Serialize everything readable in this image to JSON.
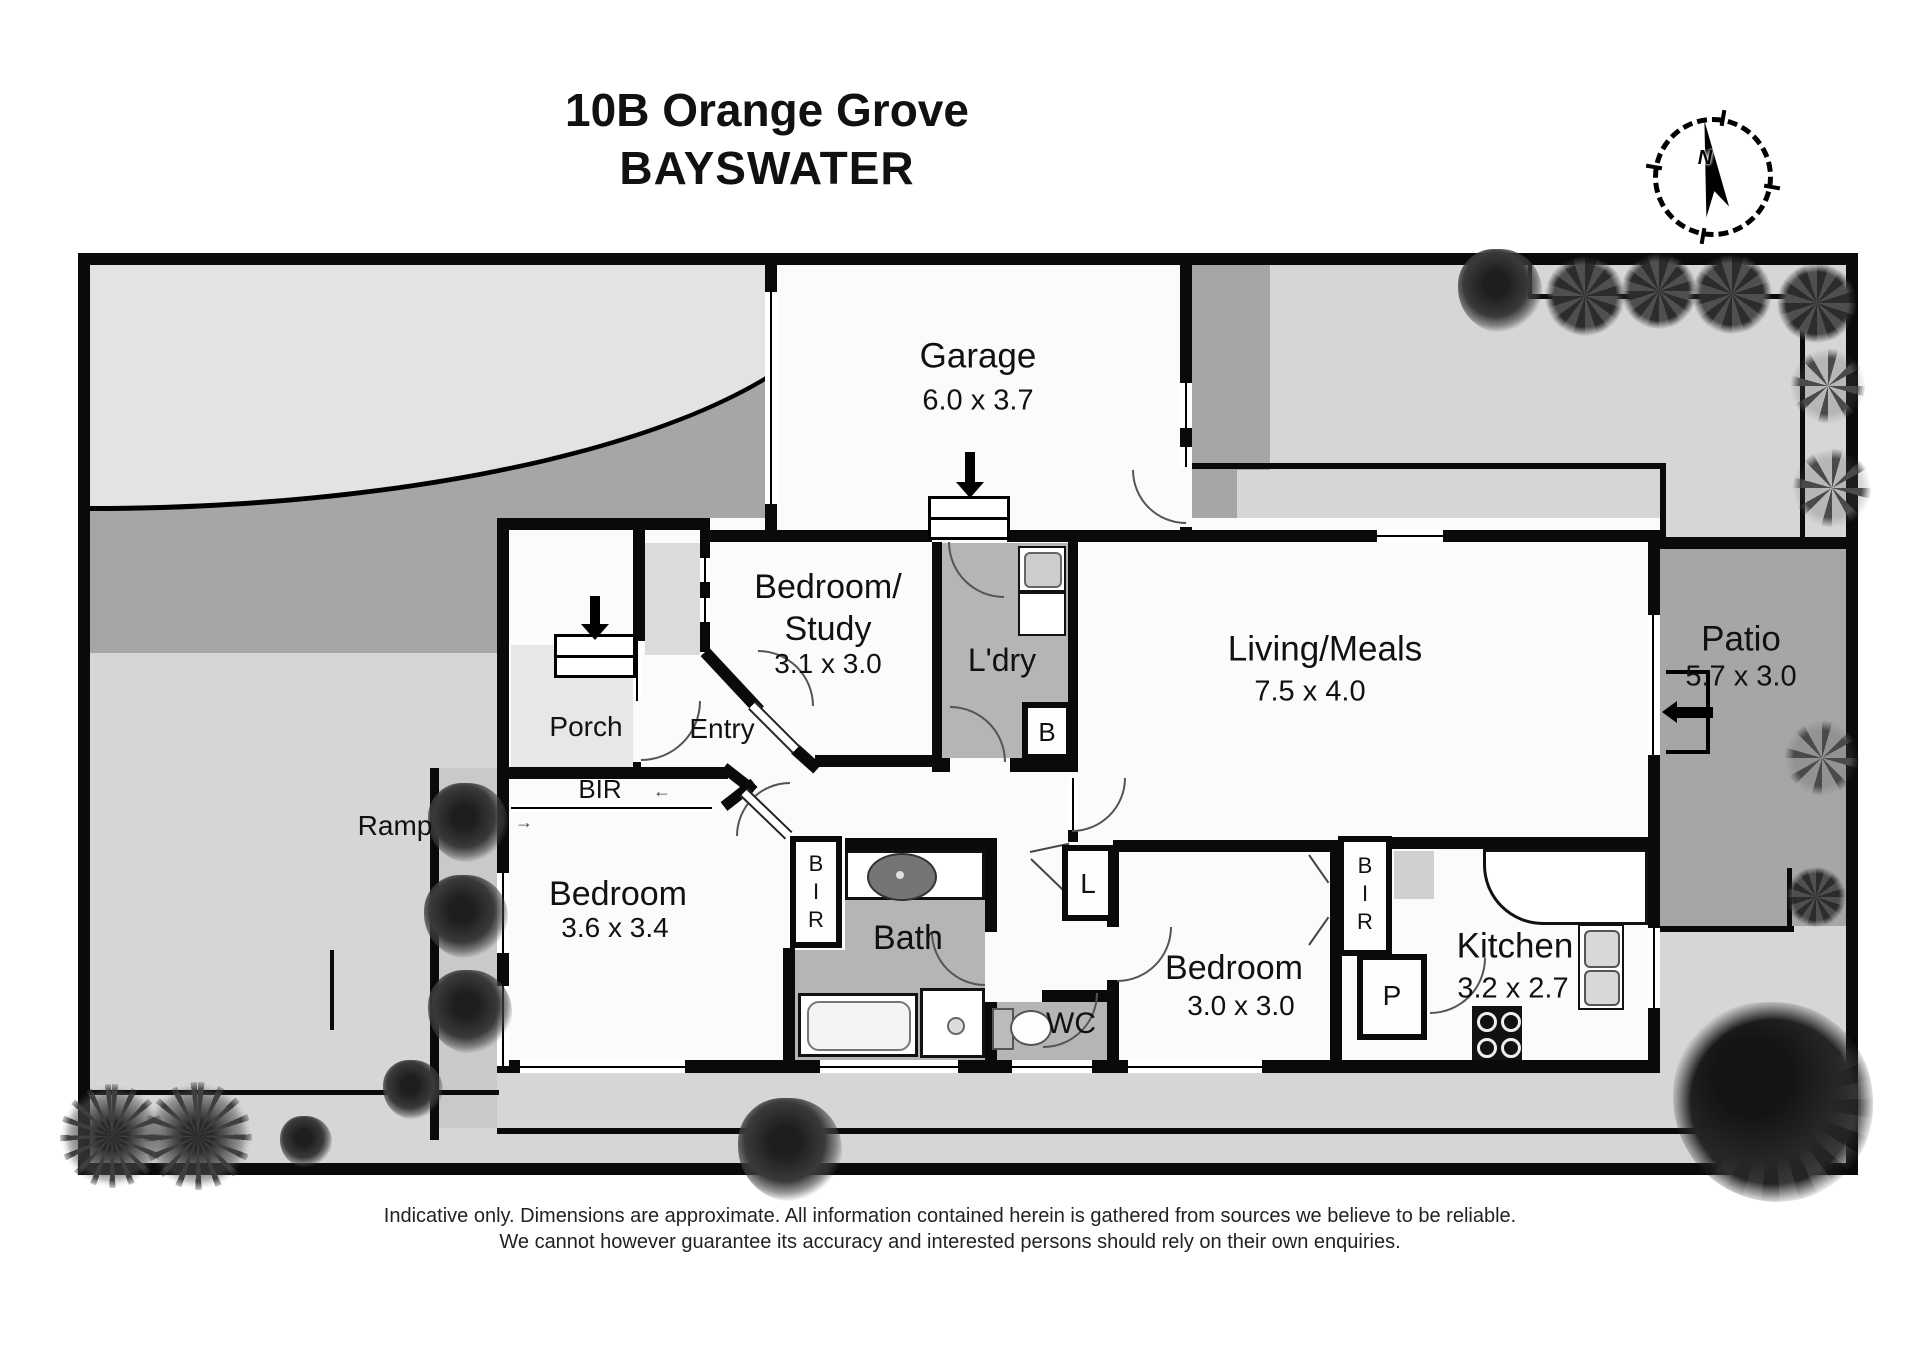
{
  "title": {
    "line1": "10B Orange Grove",
    "line2": "BAYSWATER"
  },
  "compass": {
    "label": "N"
  },
  "rooms": {
    "garage": {
      "name": "Garage",
      "dims": "6.0 x 3.7"
    },
    "bedroom_study": {
      "name": "Bedroom/",
      "name2": "Study",
      "dims": "3.1 x 3.0"
    },
    "laundry": {
      "name": "L'dry"
    },
    "living_meals": {
      "name": "Living/Meals",
      "dims": "7.5 x 4.0"
    },
    "patio": {
      "name": "Patio",
      "dims": "5.7 x 3.0"
    },
    "porch": {
      "name": "Porch"
    },
    "entry": {
      "name": "Entry"
    },
    "ramp": {
      "name": "Ramp"
    },
    "bedroom1": {
      "name": "Bedroom",
      "dims": "3.6 x 3.4"
    },
    "bathroom": {
      "name": "Bath"
    },
    "wc": {
      "name": "WC"
    },
    "bedroom2": {
      "name": "Bedroom",
      "dims": "3.0 x 3.0"
    },
    "kitchen": {
      "name": "Kitchen",
      "dims": "3.2 x 2.7"
    }
  },
  "closets": {
    "bir_band": "BIR",
    "bir1": [
      "B",
      "I",
      "R"
    ],
    "bir2": [
      "B",
      "I",
      "R"
    ],
    "linen": "L",
    "broom": "B",
    "pantry": "P"
  },
  "slide_arrows": {
    "left": "←",
    "right": "→"
  },
  "disclaimer": {
    "line1": "Indicative only. Dimensions are approximate. All information contained herein is gathered from sources we believe to be reliable.",
    "line2": "We cannot however guarantee its accuracy and interested persons should rely on their own enquiries."
  },
  "colors": {
    "wall": "#0a0a0a",
    "site": "#d6d6d6",
    "driveway": "#a6a6a6",
    "wet_floor": "#b5b5b5",
    "lawn": "#e3e3e3"
  }
}
